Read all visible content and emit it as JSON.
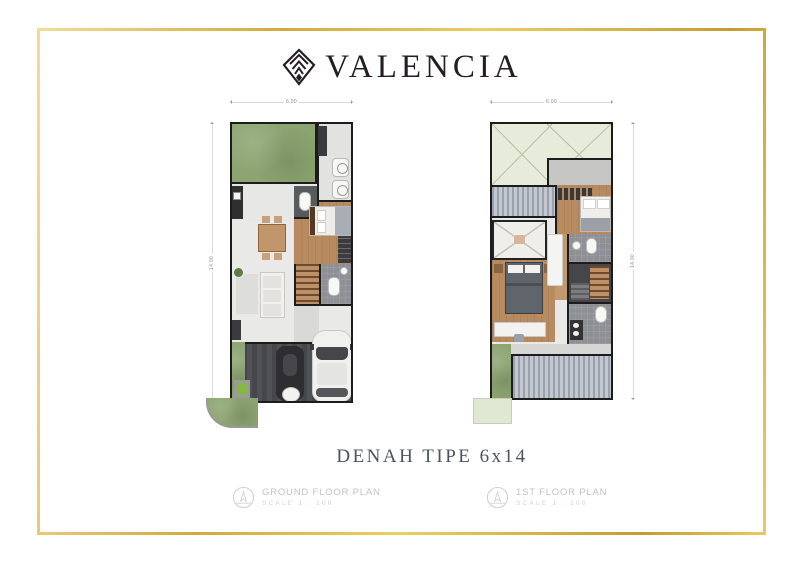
{
  "brand": {
    "name": "VALENCIA"
  },
  "caption": {
    "title": "DENAH TIPE 6x14"
  },
  "plans": [
    {
      "label": "GROUND FLOOR PLAN",
      "scale": "SCALE 1 : 100",
      "dim_width": "6.00",
      "dim_height": "14.00"
    },
    {
      "label": "1ST FLOOR PLAN",
      "scale": "SCALE 1 : 100",
      "dim_width": "6.00",
      "dim_height": "14.00"
    }
  ],
  "icons": {
    "logo_icon": "nested-chevron-diamond",
    "legend_icon": "compass-stamp-circle"
  },
  "colors": {
    "frame_gold": "#d4ab45",
    "logo_dark": "#241d23",
    "caption_gray": "#4d535e",
    "legend_gray": "#c2c2c2",
    "garden_green": "#8ca471",
    "void_green": "#e6ecd9",
    "wood_floor": "#b78a5f",
    "wall_black": "#1c1c1c",
    "carport_gray": "#4a4b4f",
    "deck_gray": "#aab1bc"
  }
}
